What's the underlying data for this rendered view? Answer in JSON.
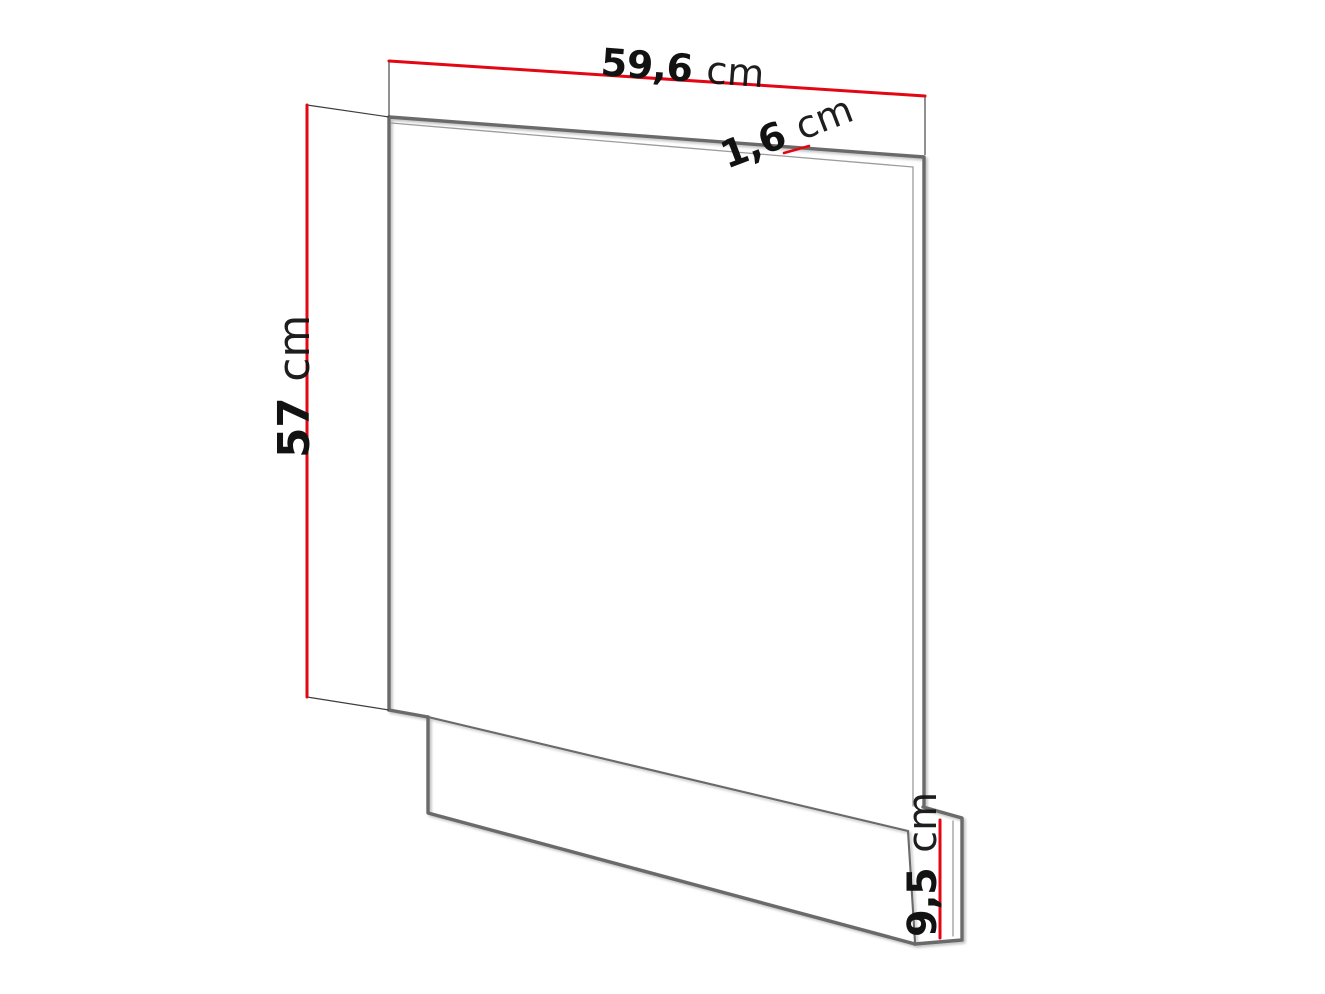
{
  "figure": {
    "kind": "furniture-panel-dimension-diagram",
    "dimensions": {
      "width": {
        "value": "59,6",
        "unit": "cm"
      },
      "panel_thickness": {
        "value": "1,6",
        "unit": "cm"
      },
      "height": {
        "value": "57",
        "unit": "cm"
      },
      "plinth_height": {
        "value": "9,5",
        "unit": "cm"
      }
    },
    "colors": {
      "dimension_line": "#e30613",
      "outline_thick": "#6a6a6a",
      "outline_thin": "#9c9c9c",
      "extension_line": "#3d3d3d",
      "label_text": "#121212",
      "background": "#ffffff"
    }
  }
}
